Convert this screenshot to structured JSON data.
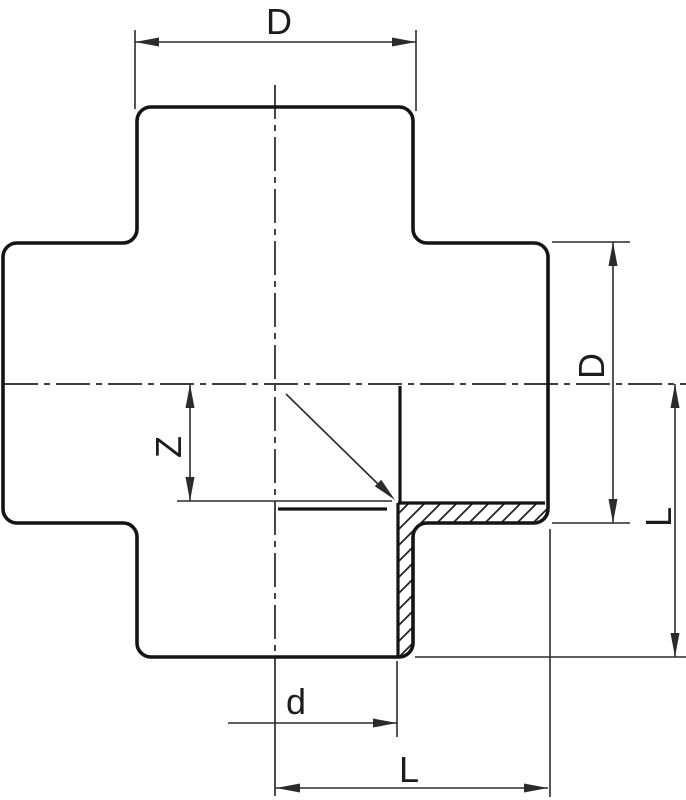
{
  "figure": {
    "title": "Cross fitting sectional technical drawing",
    "type": "technical-diagram",
    "labels": {
      "outer_diameter_top": "D",
      "outer_diameter_right": "D",
      "insertion_depth": "Z",
      "inner_diameter": "d",
      "length_right": "L",
      "length_bottom": "L"
    },
    "colors": {
      "background": "#ffffff",
      "outline": "#141414",
      "dimension": "#2b2b2b",
      "centerline": "#3d3d3d"
    }
  }
}
